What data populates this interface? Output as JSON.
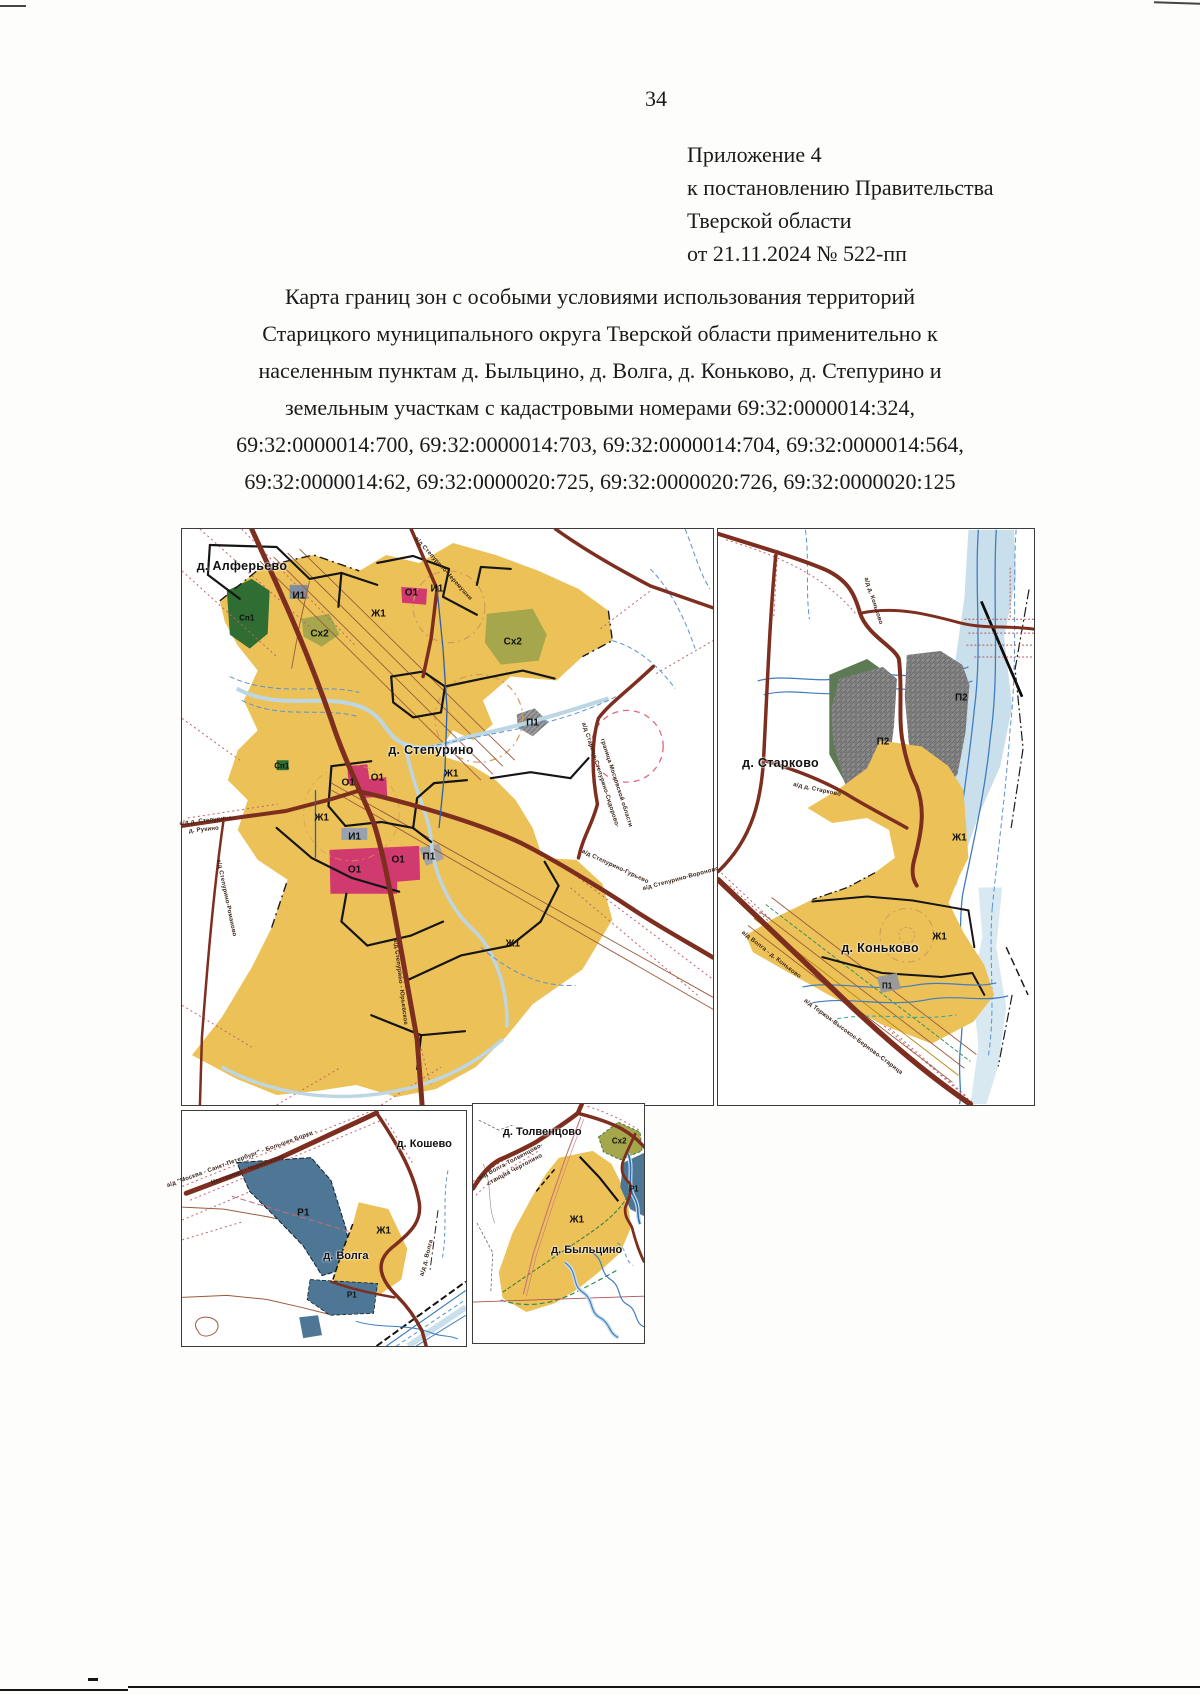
{
  "page": {
    "number": "34",
    "appendix_lines": [
      "Приложение 4",
      "к постановлению Правительства",
      "Тверской области",
      "от 21.11.2024 № 522-пп"
    ],
    "title_lines": [
      "Карта границ зон с особыми условиями использования территорий",
      "Старицкого муниципального округа Тверской области применительно к",
      "населенным пунктам д. Быльцино, д. Волга, д. Коньково, д. Степурино и",
      "земельным участкам с кадастровыми номерами 69:32:0000014:324,",
      "69:32:0000014:700, 69:32:0000014:703, 69:32:0000014:704, 69:32:0000014:564,",
      "69:32:0000014:62, 69:32:0000020:725, 69:32:0000020:726, 69:32:0000020:125"
    ]
  },
  "colors": {
    "zone_residential_yellow": "#ecc258",
    "zone_public_pink": "#d13a6e",
    "zone_special_green": "#2f6d33",
    "zone_agro_olive": "#a6a64c",
    "zone_industrial_gray": "#8c8c8c",
    "zone_recreation_slate": "#4e7796",
    "road_maroon": "#7d2e1f",
    "water_blue": "#3f7cc0",
    "water_light": "#c9dfeb",
    "topo_red": "#c4606c"
  },
  "maps": {
    "stepurino": {
      "labels": [
        {
          "t": "д. Алферьево",
          "x": 11.3,
          "y": 6.4,
          "c": "place"
        },
        {
          "t": "Сп1",
          "x": 12.2,
          "y": 15.4,
          "c": "zone-sm"
        },
        {
          "t": "И1",
          "x": 22.0,
          "y": 11.6,
          "c": "zone"
        },
        {
          "t": "Сх2",
          "x": 25.9,
          "y": 18.2,
          "c": "zone"
        },
        {
          "t": "О1",
          "x": 43.2,
          "y": 11.1,
          "c": "zone"
        },
        {
          "t": "И1",
          "x": 48.0,
          "y": 10.4,
          "c": "zone"
        },
        {
          "t": "Ж1",
          "x": 37.0,
          "y": 14.7,
          "c": "zone"
        },
        {
          "t": "Сх2",
          "x": 62.3,
          "y": 19.7,
          "c": "zone"
        },
        {
          "t": "П1",
          "x": 66.0,
          "y": 33.7,
          "c": "zone"
        },
        {
          "t": "д. Степурино",
          "x": 46.9,
          "y": 38.4,
          "c": "place"
        },
        {
          "t": "Сп1",
          "x": 18.8,
          "y": 41.2,
          "c": "zone-sm"
        },
        {
          "t": "О1",
          "x": 31.3,
          "y": 44.1,
          "c": "zone"
        },
        {
          "t": "О1",
          "x": 36.8,
          "y": 43.3,
          "c": "zone"
        },
        {
          "t": "Ж1",
          "x": 50.7,
          "y": 42.6,
          "c": "zone"
        },
        {
          "t": "Ж1",
          "x": 26.3,
          "y": 50.2,
          "c": "zone"
        },
        {
          "t": "И1",
          "x": 32.5,
          "y": 53.5,
          "c": "zone"
        },
        {
          "t": "П1",
          "x": 46.5,
          "y": 56.9,
          "c": "zone"
        },
        {
          "t": "О1",
          "x": 32.5,
          "y": 59.2,
          "c": "zone"
        },
        {
          "t": "О1",
          "x": 40.7,
          "y": 57.4,
          "c": "zone"
        },
        {
          "t": "Ж1",
          "x": 62.3,
          "y": 72.1,
          "c": "zone"
        },
        {
          "t": "а/д Степурино-Черемушки",
          "x": 49.2,
          "y": 6.9,
          "c": "road",
          "r": 48
        },
        {
          "t": "а/д Старица-Степурино-Сидорово-",
          "x": 78.8,
          "y": 42.7,
          "c": "road",
          "r": 72
        },
        {
          "t": "граница Московской области",
          "x": 81.8,
          "y": 44.1,
          "c": "road",
          "r": 72
        },
        {
          "t": "а/д Степурино-Гурьево",
          "x": 81.6,
          "y": 58.7,
          "c": "road",
          "r": 25
        },
        {
          "t": "а/д д. Степурино-",
          "x": 4.7,
          "y": 50.7,
          "c": "road",
          "r": -6
        },
        {
          "t": "д. Рукино",
          "x": 4.1,
          "y": 52.3,
          "c": "road",
          "r": -6
        },
        {
          "t": "а/д Степурино-Романово",
          "x": 8.3,
          "y": 64.0,
          "c": "road",
          "r": 78
        },
        {
          "t": "а/д Степурино - Юрьевское",
          "x": 41.1,
          "y": 78.7,
          "c": "road",
          "r": 83
        },
        {
          "t": "а/д Степурино-Вороново",
          "x": 94.0,
          "y": 60.7,
          "c": "road",
          "r": -15
        }
      ]
    },
    "konkovo": {
      "labels": [
        {
          "t": "д. Старково",
          "x": 19.8,
          "y": 40.7,
          "c": "place"
        },
        {
          "t": "П2",
          "x": 77.0,
          "y": 29.4,
          "c": "zone"
        },
        {
          "t": "П2",
          "x": 52.2,
          "y": 37.0,
          "c": "zone"
        },
        {
          "t": "Ж1",
          "x": 76.4,
          "y": 53.6,
          "c": "zone"
        },
        {
          "t": "Ж1",
          "x": 70.1,
          "y": 70.8,
          "c": "zone"
        },
        {
          "t": "д. Коньково",
          "x": 51.3,
          "y": 72.8,
          "c": "place"
        },
        {
          "t": "П1",
          "x": 53.5,
          "y": 79.4,
          "c": "zone-sm"
        },
        {
          "t": "а/д д. Старково",
          "x": 31.4,
          "y": 45.3,
          "c": "road",
          "r": 12
        },
        {
          "t": "а/д д. Коньково",
          "x": 49.1,
          "y": 12.5,
          "c": "road",
          "r": 72
        },
        {
          "t": "а/д Волга - д. Коньково",
          "x": 16.7,
          "y": 73.9,
          "c": "road",
          "r": 38
        },
        {
          "t": "а/д Торжок-Высокое-Берново-Старица",
          "x": 42.8,
          "y": 88.2,
          "c": "road",
          "r": 37
        }
      ]
    },
    "volga": {
      "labels": [
        {
          "t": "д. Кошево",
          "x": 85.3,
          "y": 13.9,
          "c": "place-sm"
        },
        {
          "t": "Р1",
          "x": 42.7,
          "y": 43.5,
          "c": "zone"
        },
        {
          "t": "Ж1",
          "x": 71.0,
          "y": 51.1,
          "c": "zone"
        },
        {
          "t": "д. Волга",
          "x": 57.7,
          "y": 61.6,
          "c": "place-sm"
        },
        {
          "t": "Р1",
          "x": 59.8,
          "y": 78.1,
          "c": "zone-sm"
        },
        {
          "t": "а/д \"Москва - Санкт-Петербург\" - Большие Борки -",
          "x": 21.0,
          "y": 20.3,
          "c": "road",
          "r": -20
        },
        {
          "t": "Нестерово - Черничкино",
          "x": 23.1,
          "y": 24.9,
          "c": "road",
          "r": -20
        },
        {
          "t": "а/д д. Волга",
          "x": 86.4,
          "y": 62.7,
          "c": "road",
          "r": -75
        }
      ]
    },
    "bylcino": {
      "labels": [
        {
          "t": "д. Толвенцово",
          "x": 40.5,
          "y": 11.6,
          "c": "place-sm"
        },
        {
          "t": "Сх2",
          "x": 85.5,
          "y": 15.4,
          "c": "zone-sm"
        },
        {
          "t": "Р1",
          "x": 94.0,
          "y": 35.7,
          "c": "zone-sm"
        },
        {
          "t": "Ж1",
          "x": 60.7,
          "y": 48.5,
          "c": "zone"
        },
        {
          "t": "д. Быльцино",
          "x": 66.5,
          "y": 61.0,
          "c": "place-sm"
        },
        {
          "t": "а/д Волга-Толвенцово-",
          "x": 22.0,
          "y": 24.1,
          "c": "road",
          "r": -28
        },
        {
          "t": "станция Чертолино",
          "x": 24.3,
          "y": 27.8,
          "c": "road",
          "r": -28
        }
      ]
    }
  }
}
